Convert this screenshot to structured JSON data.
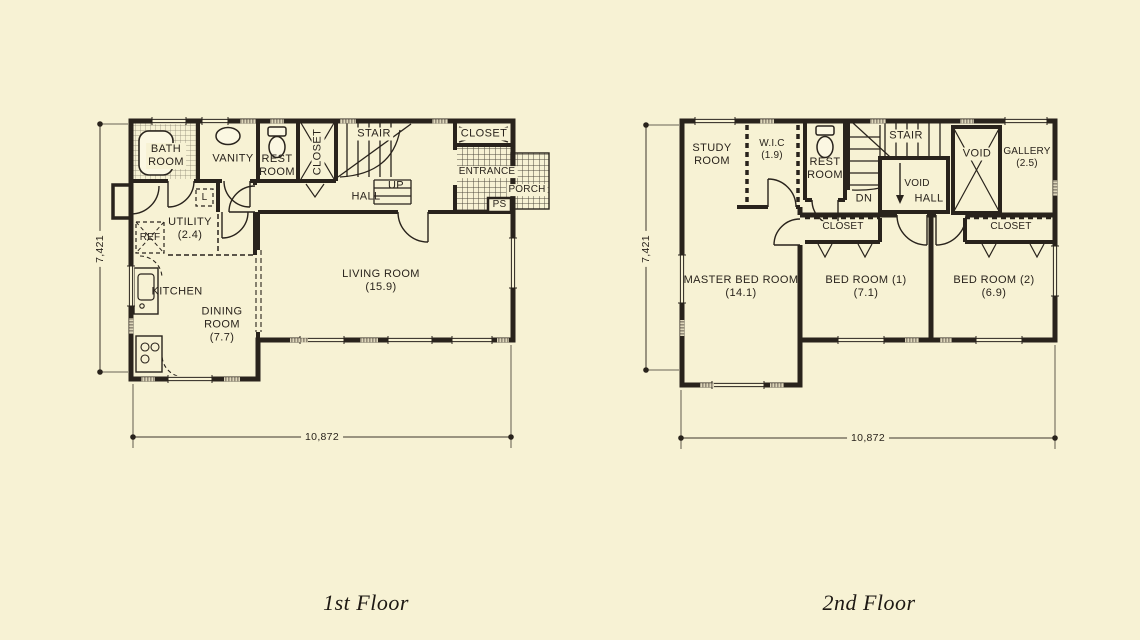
{
  "page": {
    "paper_color": "#f7f2d4",
    "ink_color": "#29231c"
  },
  "floors": [
    {
      "title": "1st Floor",
      "dimensions": {
        "width": "10,872",
        "height": "7,421"
      },
      "rooms": {
        "bath": "BATH\nROOM",
        "vanity": "VANITY",
        "rest": "REST\nROOM",
        "closet_hall": "CLOSET",
        "stair": "STAIR",
        "up": "UP",
        "hall": "HALL",
        "closet_entry": "CLOSET",
        "entrance": "ENTRANCE",
        "porch": "PORCH",
        "ps": "PS",
        "laundry": "L",
        "utility": "UTILITY\n(2.4)",
        "ref": "REF",
        "kitchen": "KITCHEN",
        "dining": "DINING\nROOM\n(7.7)",
        "living": "LIVING ROOM\n(15.9)"
      }
    },
    {
      "title": "2nd Floor",
      "dimensions": {
        "width": "10,872",
        "height": "7,421"
      },
      "rooms": {
        "study": "STUDY\nROOM",
        "wic": "W.I.C\n(1.9)",
        "rest": "REST\nROOM",
        "stair": "STAIR",
        "void_small": "VOID",
        "dn": "DN",
        "void_large": "VOID",
        "gallery": "GALLERY\n(2.5)",
        "hall": "HALL",
        "closet_1": "CLOSET",
        "closet_2": "CLOSET",
        "master": "MASTER BED ROOM\n(14.1)",
        "bed1": "BED ROOM (1)\n(7.1)",
        "bed2": "BED ROOM (2)\n(6.9)"
      }
    }
  ]
}
